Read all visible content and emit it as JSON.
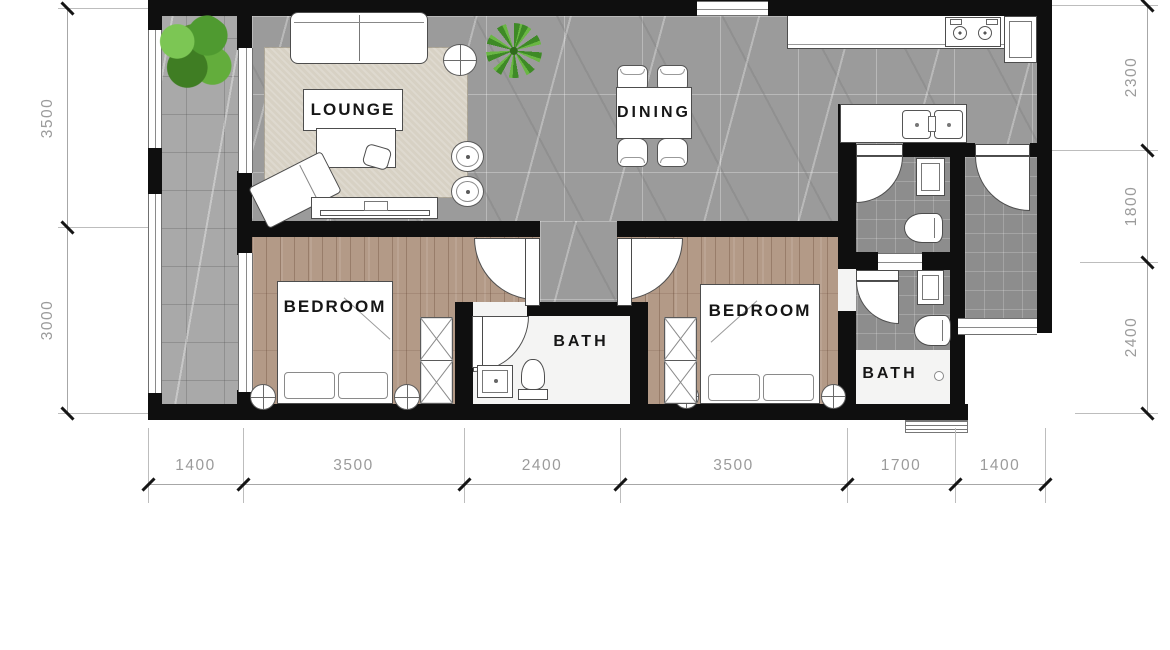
{
  "plan": {
    "title": "apartment-floor-plan",
    "rooms": {
      "lounge": "LOUNGE",
      "dining": "DINING",
      "bedroom1": "BEDROOM",
      "bedroom2": "BEDROOM",
      "bath_middle": "BATH",
      "bath_right": "BATH"
    },
    "dimensions": {
      "bottom": [
        "1400",
        "3500",
        "2400",
        "3500",
        "1700",
        "1400"
      ],
      "left": [
        "3500",
        "3000"
      ],
      "right": [
        "2300",
        "1800",
        "2400"
      ]
    },
    "colors": {
      "wall": "#0f0f0f",
      "marble_tile": "#9b9b9b",
      "balcony_tile": "#a9a9a9",
      "dark_tile": "#8d8d8d",
      "wood_floor": "#b39a87",
      "rug": "#d7d1c4",
      "plant_green": "#558f2f",
      "dimension_text": "#9b9b9b"
    },
    "icons": [
      "tree-plant-icon",
      "palm-plant-icon",
      "sofa-icon",
      "ceiling-fan-icon",
      "stool-icon",
      "tv-console-icon",
      "chaise-icon",
      "dining-table-icon",
      "dining-chair-icon",
      "stove-icon",
      "sink-icon",
      "fridge-icon",
      "toilet-icon",
      "vanity-icon",
      "wardrobe-icon",
      "bed-icon",
      "rug-mat-icon",
      "door-swing-icon",
      "window-icon",
      "dimension-tick-icon"
    ]
  }
}
